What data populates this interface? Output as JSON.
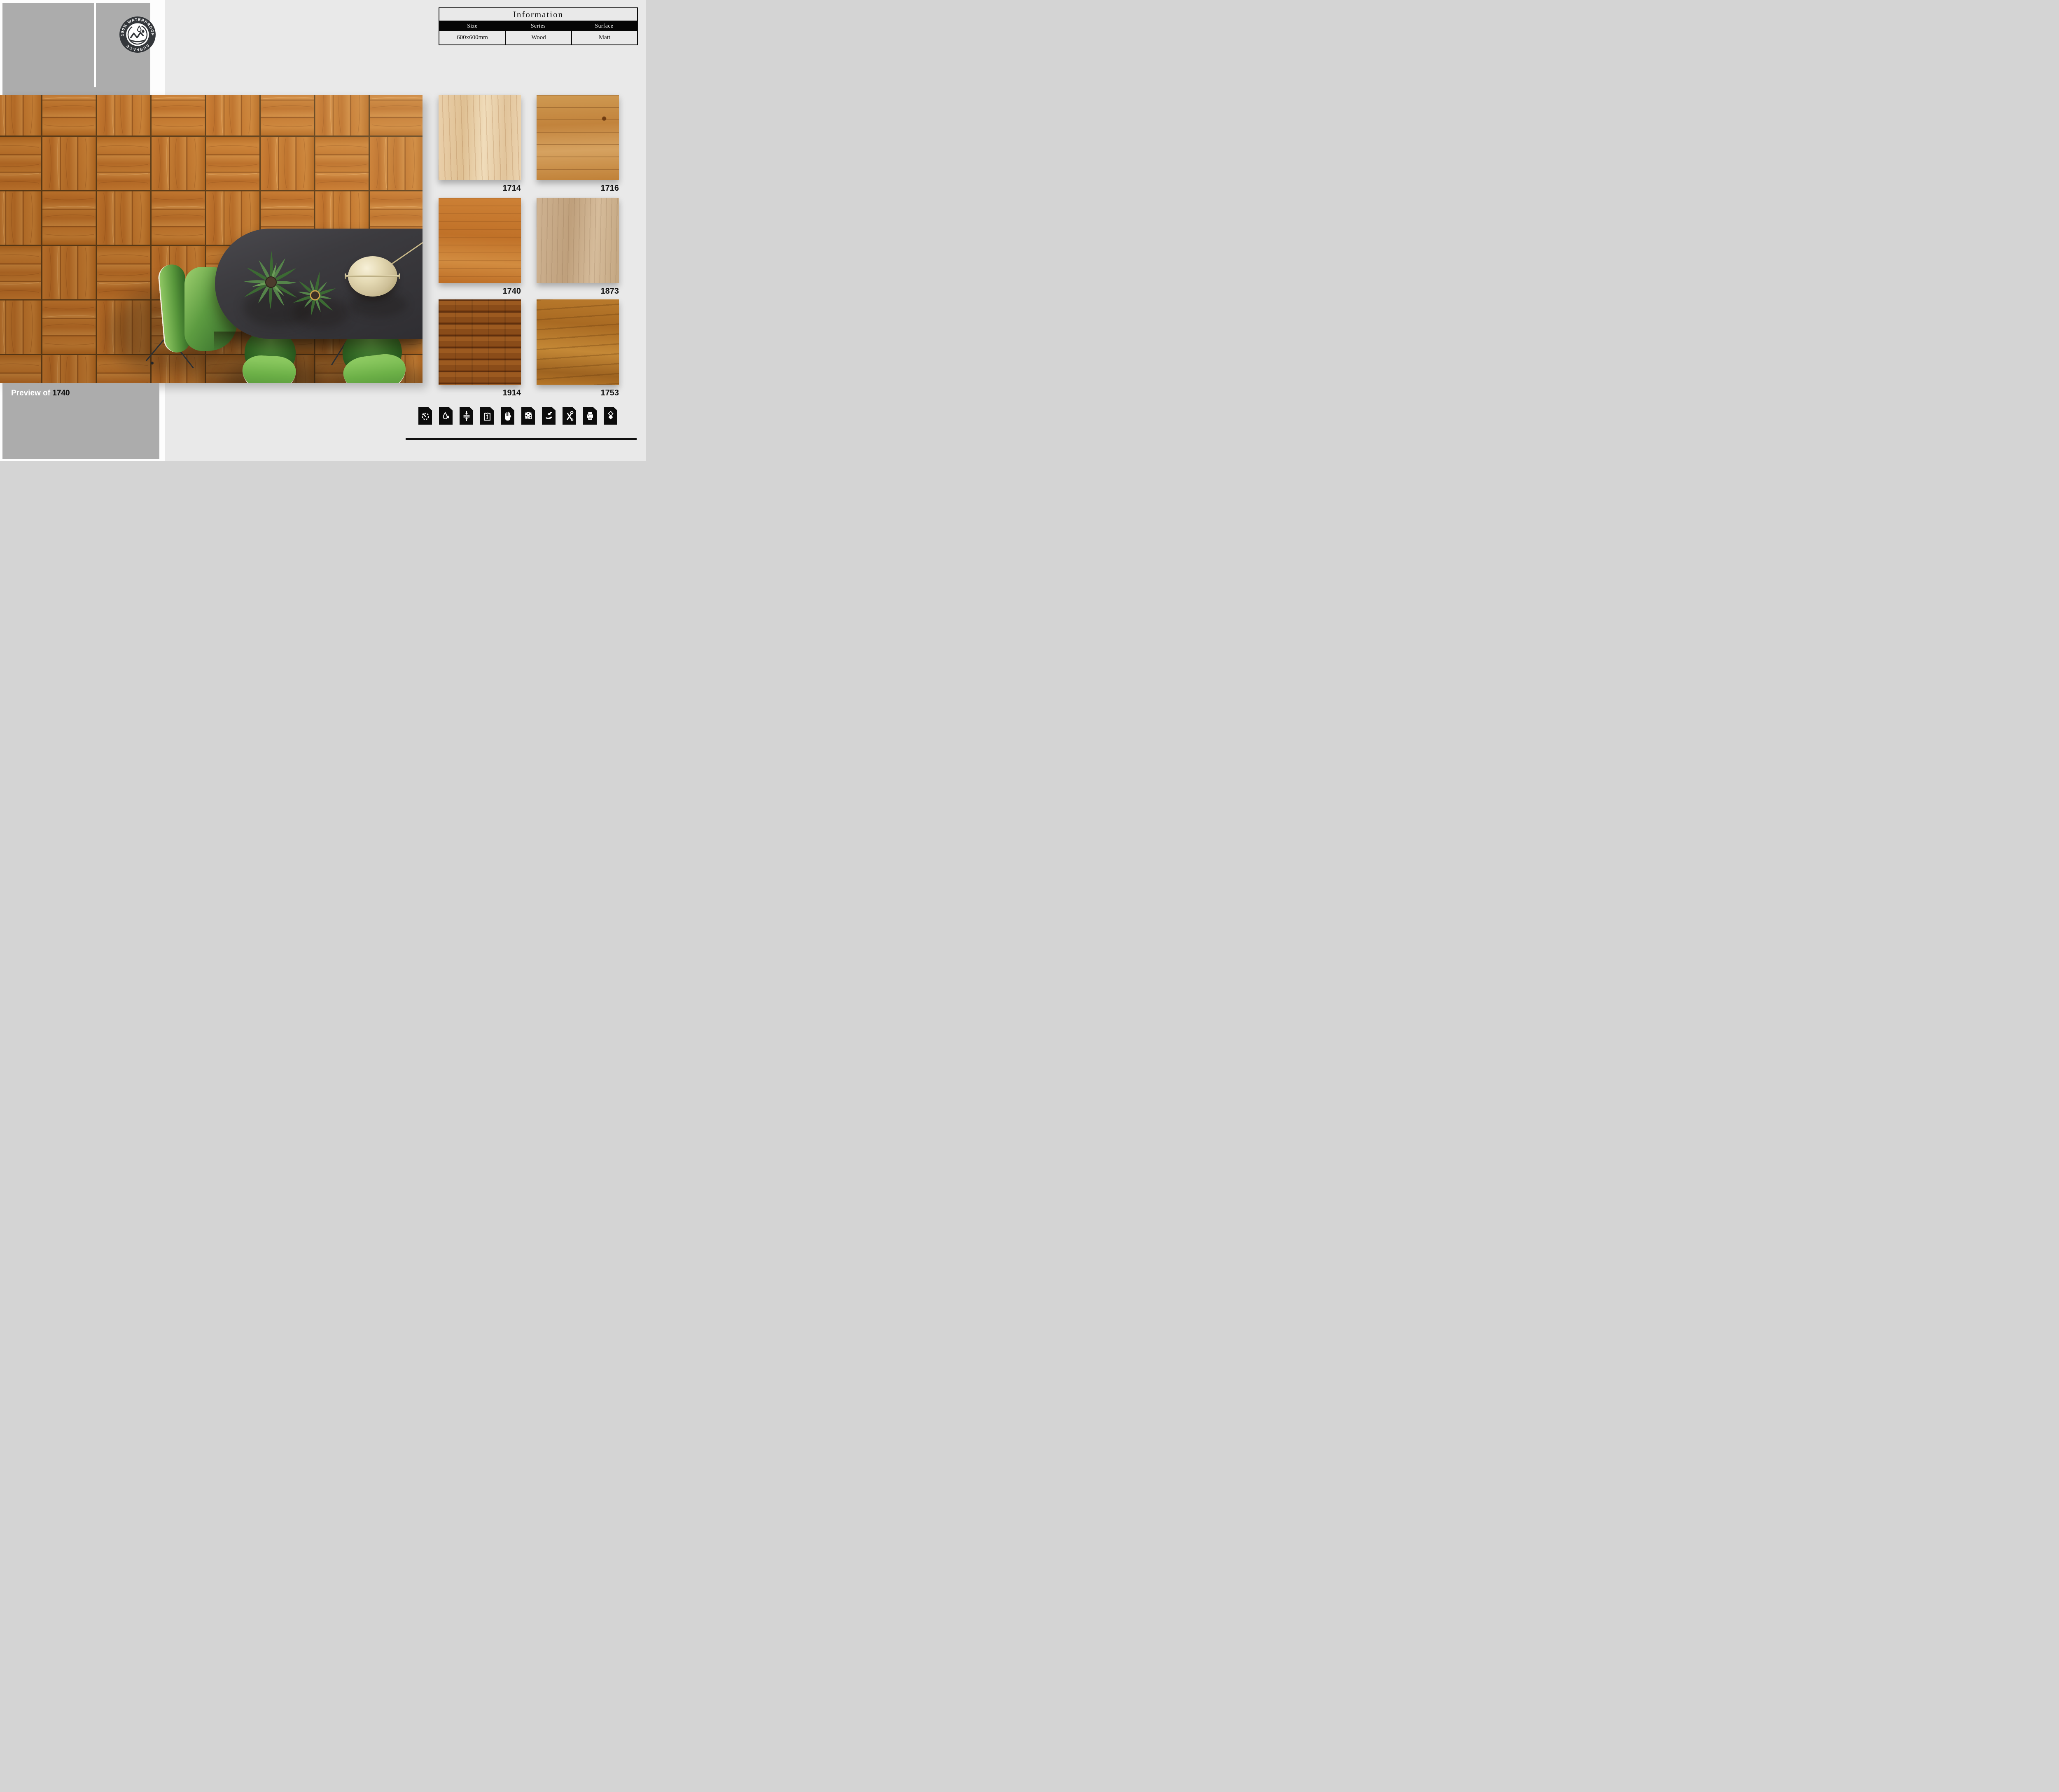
{
  "info_table": {
    "title": "Information",
    "headers": [
      "Size",
      "Series",
      "Surface"
    ],
    "values": [
      "600x600mm",
      "Wood",
      "Matt"
    ]
  },
  "badge": {
    "arc_top": "100% WATERPROOF",
    "arc_bottom": "SURFACE"
  },
  "preview": {
    "label_prefix": "Preview of",
    "label_code": "1740"
  },
  "swatches": [
    {
      "code": "1714",
      "tone": "light cream oak, vertical grain"
    },
    {
      "code": "1716",
      "tone": "rustic orange oak, horizontal cracks and knots"
    },
    {
      "code": "1740",
      "tone": "orange oak, horizontal grain (used in preview)"
    },
    {
      "code": "1873",
      "tone": "pale taupe wood, vertical grain"
    },
    {
      "code": "1914",
      "tone": "dark stained horizontal planks"
    },
    {
      "code": "1753",
      "tone": "golden walnut, wavy horizontal grain"
    }
  ],
  "feature_icons": [
    "gauge",
    "water-drops",
    "compression-strength",
    "water-absorption",
    "anti-slip-hand",
    "design-grid",
    "eco-friendly",
    "tools",
    "printer",
    "layers"
  ],
  "colors": {
    "page_bg": "#e9e9e9",
    "panel_gray": "#acacac",
    "accent_black": "#0c0c0c",
    "wood_base": "#c0722a",
    "chair_green": "#6cb047",
    "table_charcoal": "#3c3b3f",
    "lamp_gold": "#cdbf97"
  }
}
